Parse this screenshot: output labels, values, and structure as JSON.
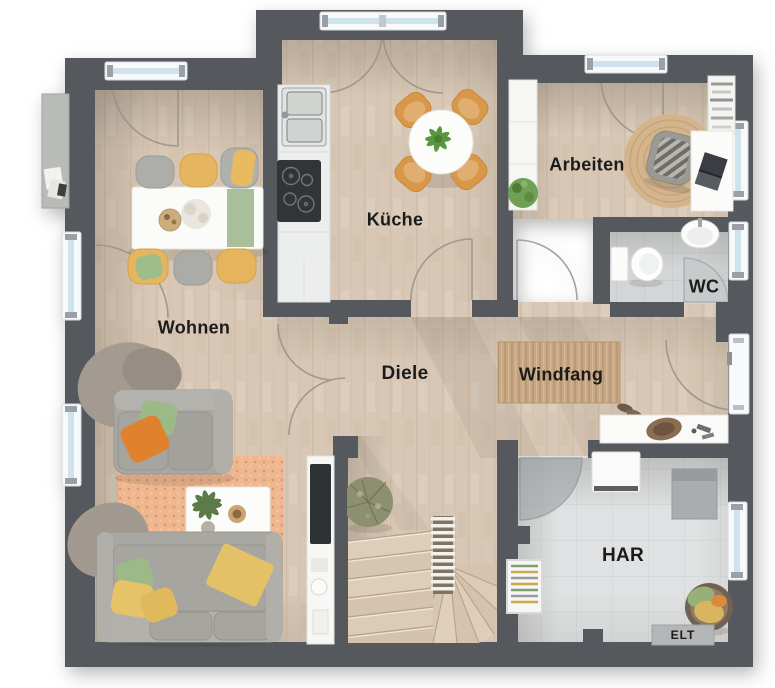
{
  "plan": {
    "type": "floor-plan",
    "labels": {
      "wohnen": "Wohnen",
      "kueche": "Küche",
      "arbeiten": "Arbeiten",
      "wc": "WC",
      "diele": "Diele",
      "windfang": "Windfang",
      "har": "HAR",
      "elt": "ELT"
    },
    "palette": {
      "background": "#ffffff",
      "wall": "#54585c",
      "wood_floor": "#d8c7b4",
      "wood_line": "#c3ae96",
      "tile_wc": "#d3d5d6",
      "tile_har": "#dfe1e2",
      "window_frame": "#f7f9fa",
      "window_glass": "#cfe3ee",
      "door_arc": "#97918a",
      "furniture_white": "#fafaf8",
      "sofa_grey": "#a8a7a2",
      "chair_wood": "#d9984a",
      "accent_orange": "#e0812f",
      "accent_green": "#9cba87",
      "accent_yellow": "#e6c268",
      "rug_orange": "#efb790",
      "jute": "#d4b48c",
      "doormat": "#c7a884",
      "cooktop_black": "#303438",
      "elt_grey": "#b4b6b8",
      "label_color": "#1b1b1b"
    },
    "furniture": {
      "wohnen": [
        "sideboard",
        "dining-table",
        "six-chairs",
        "two-sofas",
        "coffee-table",
        "rug",
        "tv-lowboard"
      ],
      "kueche": [
        "kitchen-counter",
        "sink",
        "cooktop",
        "round-table",
        "four-chairs"
      ],
      "arbeiten": [
        "wardrobe",
        "bookshelf",
        "desk",
        "laptop",
        "office-chair",
        "round-rug",
        "plant"
      ],
      "wc": [
        "toilet",
        "washbasin"
      ],
      "windfang": [
        "doormat",
        "shoe-sideboard",
        "entrance-door"
      ],
      "stairs": [
        "winder-staircase",
        "railing",
        "plant"
      ],
      "har": [
        "washing-machine",
        "utility-unit",
        "drying-rack",
        "laundry-basket",
        "elt-box"
      ]
    }
  }
}
